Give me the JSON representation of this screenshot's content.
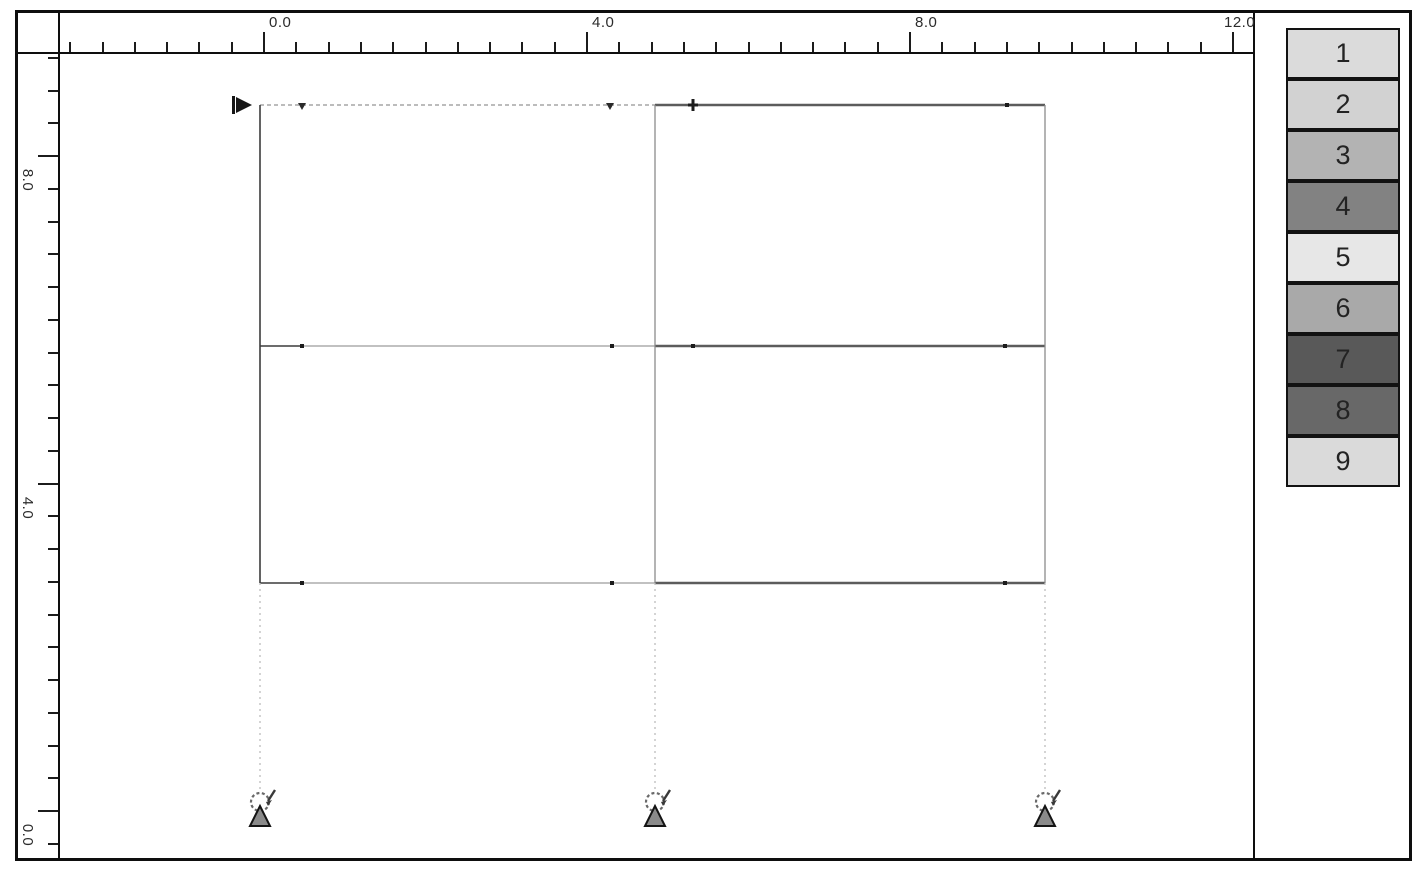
{
  "rulers": {
    "horizontal": {
      "tick_origin": 245,
      "tick_spacing": 32.3,
      "k_min": -6,
      "k_max": 30,
      "labels": [
        {
          "text": "0.0",
          "x": 251
        },
        {
          "text": "4.0",
          "x": 574
        },
        {
          "text": "8.0",
          "x": 897
        },
        {
          "text": "12.0",
          "x": 1206
        }
      ]
    },
    "vertical": {
      "tick_origin": 142,
      "tick_spacing": 32.75,
      "k_min": -3,
      "k_max": 21,
      "labels": [
        {
          "text": "8.0",
          "y": 159
        },
        {
          "text": "4.0",
          "y": 487
        },
        {
          "text": "0.0",
          "y": 814
        }
      ]
    }
  },
  "palette": {
    "items": [
      {
        "label": "1",
        "color": "#dbdbdb"
      },
      {
        "label": "2",
        "color": "#d2d2d2"
      },
      {
        "label": "3",
        "color": "#b3b3b3"
      },
      {
        "label": "4",
        "color": "#828282"
      },
      {
        "label": "5",
        "color": "#e7e7e7"
      },
      {
        "label": "6",
        "color": "#a9a9a9"
      },
      {
        "label": "7",
        "color": "#595959"
      },
      {
        "label": "8",
        "color": "#686868"
      },
      {
        "label": "9",
        "color": "#dadada"
      }
    ]
  },
  "structure": {
    "members": [
      {
        "x1": 200,
        "y1": 51,
        "x2": 595,
        "y2": 51,
        "style": "dash-light"
      },
      {
        "x1": 595,
        "y1": 51,
        "x2": 985,
        "y2": 51,
        "style": "thick"
      },
      {
        "x1": 200,
        "y1": 292,
        "x2": 242,
        "y2": 292,
        "style": "dark-thin"
      },
      {
        "x1": 242,
        "y1": 292,
        "x2": 595,
        "y2": 292,
        "style": "light"
      },
      {
        "x1": 595,
        "y1": 292,
        "x2": 985,
        "y2": 292,
        "style": "thick"
      },
      {
        "x1": 200,
        "y1": 529,
        "x2": 242,
        "y2": 529,
        "style": "dark-thin"
      },
      {
        "x1": 242,
        "y1": 529,
        "x2": 595,
        "y2": 529,
        "style": "light"
      },
      {
        "x1": 595,
        "y1": 529,
        "x2": 985,
        "y2": 529,
        "style": "thick"
      },
      {
        "x1": 200,
        "y1": 51,
        "x2": 200,
        "y2": 529,
        "style": "dark-thin"
      },
      {
        "x1": 595,
        "y1": 51,
        "x2": 595,
        "y2": 529,
        "style": "mid"
      },
      {
        "x1": 985,
        "y1": 51,
        "x2": 985,
        "y2": 529,
        "style": "mid"
      },
      {
        "x1": 200,
        "y1": 529,
        "x2": 200,
        "y2": 737,
        "style": "dropline"
      },
      {
        "x1": 595,
        "y1": 529,
        "x2": 595,
        "y2": 737,
        "style": "dropline"
      },
      {
        "x1": 985,
        "y1": 529,
        "x2": 985,
        "y2": 737,
        "style": "dropline"
      }
    ],
    "line_styles": {
      "dash-light": {
        "stroke": "#a6a6a6",
        "width": 1.4,
        "dash": "4 3"
      },
      "light": {
        "stroke": "#9c9c9c",
        "width": 1.2,
        "dash": ""
      },
      "mid": {
        "stroke": "#8c8c8c",
        "width": 1.3,
        "dash": ""
      },
      "dark-thin": {
        "stroke": "#3c3c3c",
        "width": 1.6,
        "dash": ""
      },
      "thick": {
        "stroke": "#5c5c5c",
        "width": 2.6,
        "dash": ""
      },
      "dropline": {
        "stroke": "#bdbdbd",
        "width": 1.3,
        "dash": "2 4"
      }
    },
    "nodes": [
      {
        "x": 242,
        "y": 51,
        "type": "tri"
      },
      {
        "x": 550,
        "y": 51,
        "type": "tri"
      },
      {
        "x": 633,
        "y": 51,
        "type": "cross"
      },
      {
        "x": 947,
        "y": 51,
        "type": "dot"
      },
      {
        "x": 242,
        "y": 292,
        "type": "dot"
      },
      {
        "x": 552,
        "y": 292,
        "type": "dot"
      },
      {
        "x": 633,
        "y": 292,
        "type": "dot"
      },
      {
        "x": 945,
        "y": 292,
        "type": "dot"
      },
      {
        "x": 242,
        "y": 529,
        "type": "dot"
      },
      {
        "x": 552,
        "y": 529,
        "type": "dot"
      },
      {
        "x": 945,
        "y": 529,
        "type": "dot"
      }
    ],
    "supports": {
      "xs": [
        200,
        595,
        985
      ],
      "base_y": 772
    },
    "pointer": {
      "x": 176,
      "y": 51
    }
  }
}
